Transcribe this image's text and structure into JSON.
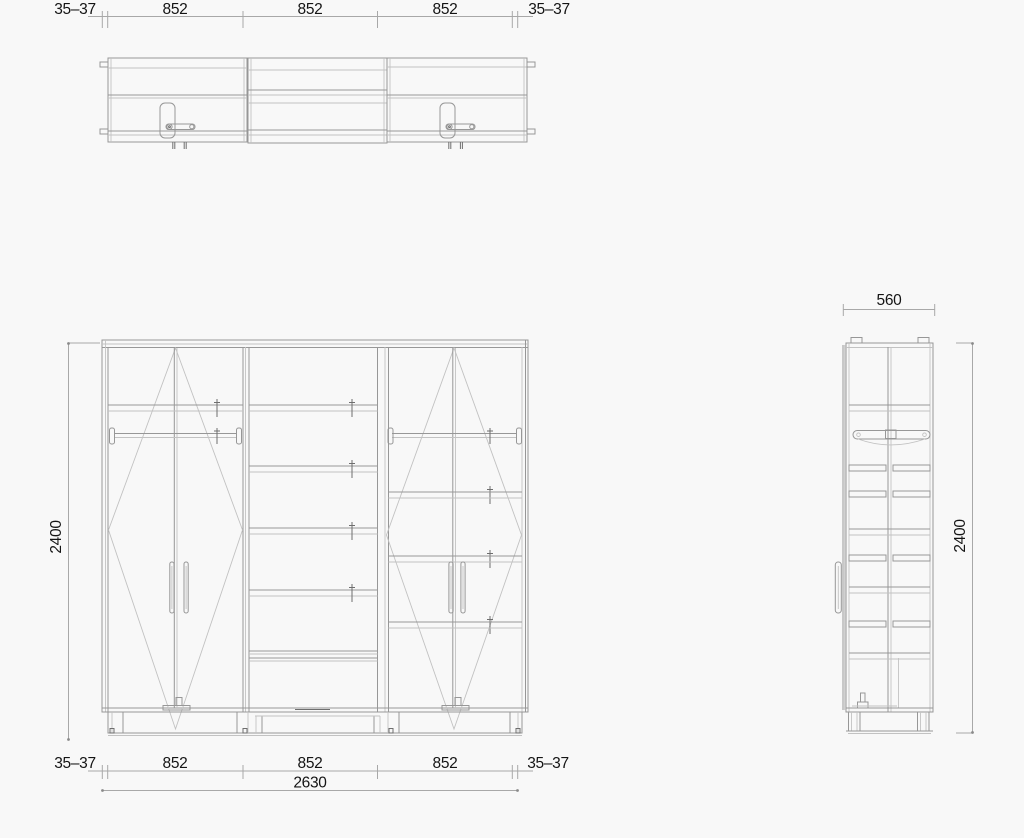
{
  "page": {
    "kind": "furniture technical drawing",
    "background": "#f8f8f8"
  },
  "colors": {
    "line": "#979797",
    "line_light": "#c2c2c2",
    "line_dark": "#6e6e6e",
    "dimension_line": "#a8a8a8",
    "dimension_text": "#141414"
  },
  "views": {
    "plan": "top view of wardrobe",
    "front": "front elevation of wardrobe",
    "side": "side elevation of wardrobe"
  },
  "dims": {
    "top_chain": [
      "35–37",
      "852",
      "852",
      "852",
      "35–37"
    ],
    "bottom_chain": [
      "35–37",
      "852",
      "852",
      "852",
      "35–37"
    ],
    "bottom_total": "2630",
    "front_height": "2400",
    "side_width": "560",
    "side_height": "2400"
  }
}
